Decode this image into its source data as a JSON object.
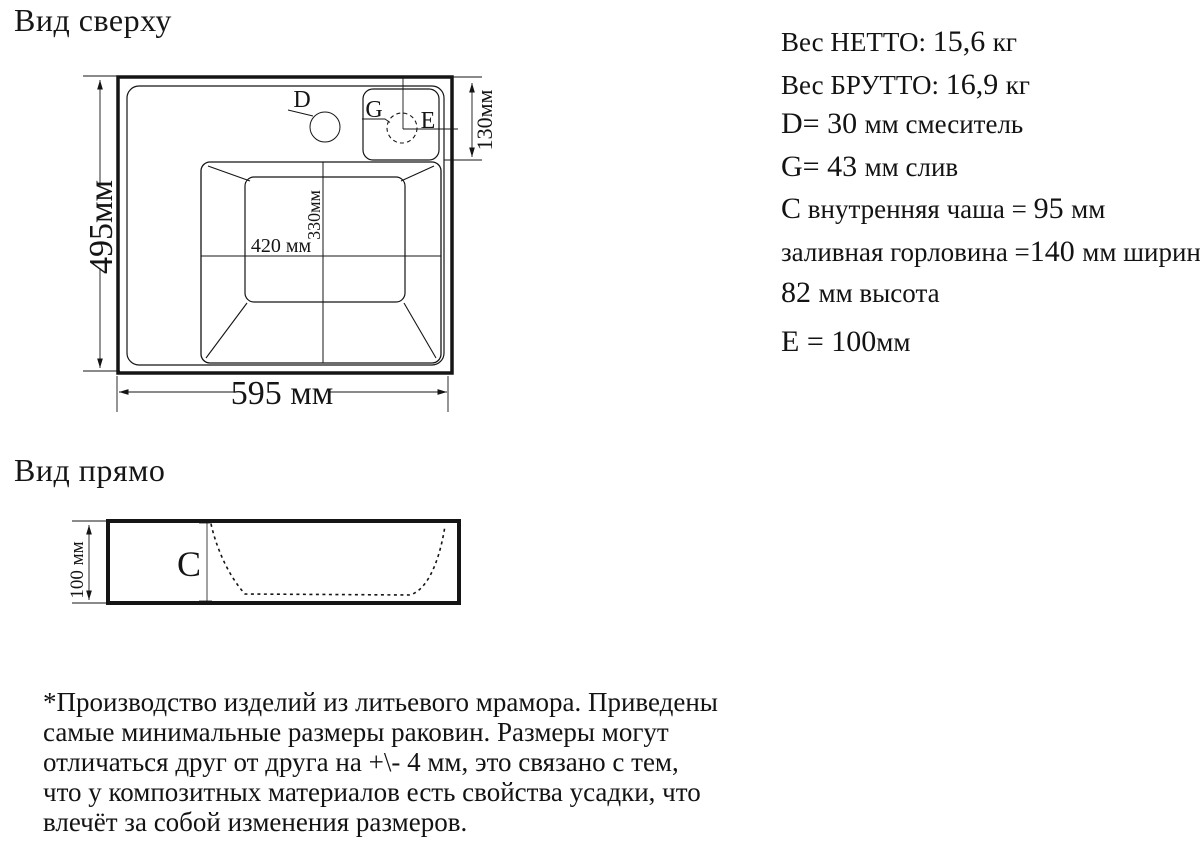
{
  "top_view": {
    "title": "Вид сверху",
    "dim_height": "495мм",
    "dim_width": "595 мм",
    "dim_offset": "130мм",
    "dim_bowl_width": "420 мм",
    "dim_bowl_height": "330мм",
    "label_faucet": "D",
    "label_drain": "G",
    "label_edge_offset": "E"
  },
  "front_view": {
    "title": "Вид прямо",
    "dim_height": "100 мм",
    "label_bowl_depth": "C"
  },
  "specs": {
    "lines": [
      [
        {
          "t": "Вес НЕТТО: "
        },
        {
          "t": "15,6 ",
          "b": 1
        },
        {
          "t": "кг"
        }
      ],
      [
        {
          "t": "Вес БРУТТО: "
        },
        {
          "t": "16,9 ",
          "b": 1
        },
        {
          "t": "кг"
        }
      ],
      [
        {
          "t": "D= 30 ",
          "b": 1
        },
        {
          "t": "мм смеситель"
        }
      ],
      [
        {
          "t": "G= 43 ",
          "b": 1
        },
        {
          "t": "мм слив"
        }
      ],
      [
        {
          "t": "C",
          "b": 1
        },
        {
          "t": " внутренняя чаша = "
        },
        {
          "t": "95 ",
          "b": 1
        },
        {
          "t": "мм"
        }
      ],
      [
        {
          "t": "заливная горловина ="
        },
        {
          "t": "140 ",
          "b": 1
        },
        {
          "t": "мм ширина,"
        }
      ],
      [
        {
          "t": "82 ",
          "b": 1
        },
        {
          "t": "мм высота"
        }
      ],
      [
        {
          "t": "E = 100",
          "b": 1
        },
        {
          "t": "мм"
        }
      ]
    ]
  },
  "footer": {
    "lines": [
      "*Производство изделий из литьевого мрамора. Приведены",
      "самые минимальные размеры раковин. Размеры могут",
      "отличаться друг от друга на +\\- 4 мм, это связано с тем,",
      "что у композитных материалов есть свойства усадки, что",
      "влечёт за собой изменения размеров."
    ]
  },
  "colors": {
    "ink": "#151515",
    "background": "#ffffff"
  }
}
